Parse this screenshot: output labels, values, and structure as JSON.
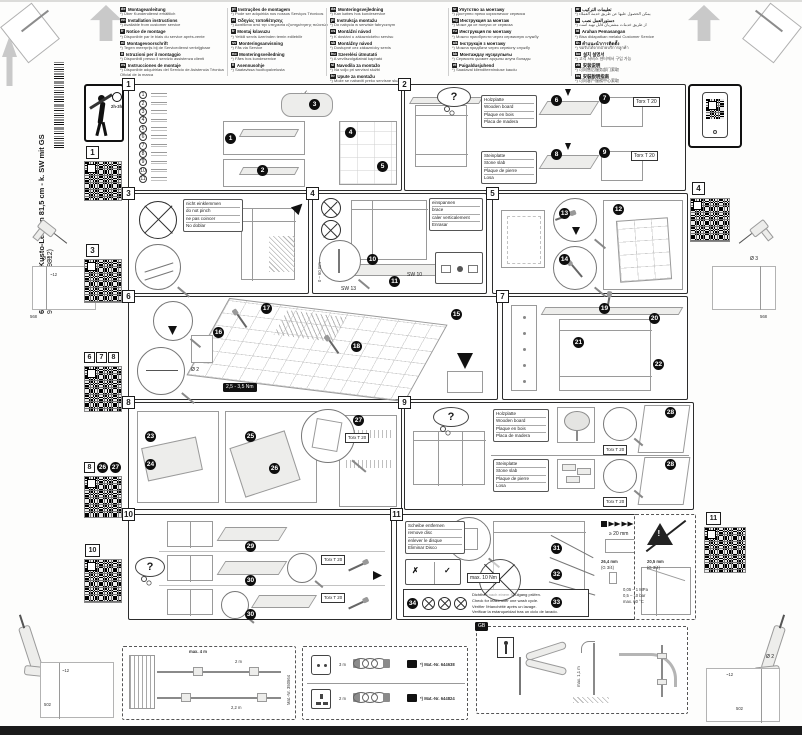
{
  "header": {
    "columns": [
      [
        {
          "code": "de",
          "title": "Montageanleitung",
          "note": "*) Über Kundendienst erhältlich"
        },
        {
          "code": "en",
          "title": "Installation instructions",
          "note": "*) Available from customer service"
        },
        {
          "code": "fr",
          "title": "Notice de montage",
          "note": "*) Disponible par le biais du service après-vente"
        },
        {
          "code": "nl",
          "title": "Montagevoorschrift",
          "note": "*) Tegen meerprijs bij de Servicedienst verkrijgbaar"
        },
        {
          "code": "it",
          "title": "Istruzioni per il montaggio",
          "note": "*) Disponibili presso il servizio assistenza clienti"
        },
        {
          "code": "es",
          "title": "Instrucciones de montaje",
          "note": "*) Disponible adquirirlas del Servicio de Asistencia Técnica Oficial de la marca"
        }
      ],
      [
        {
          "code": "pt",
          "title": "Instruções de montagem",
          "note": "*) Pode ser adquirida nos nossos Serviços Técnicos"
        },
        {
          "code": "el",
          "title": "Οδηγίες τοποθέτησης",
          "note": "*) Διατίθεται από την υπηρεσία εξυπηρέτησης πελατών"
        },
        {
          "code": "tr",
          "title": "Montaj kılavuzu",
          "note": "*) Yetkili servis üzerinden temin edilebilir"
        },
        {
          "code": "sv",
          "title": "Monteringsanvisning",
          "note": "*) Fås via Service"
        },
        {
          "code": "no",
          "title": "Monteringsveiledning",
          "note": "*) Fåes hos kundeservice"
        },
        {
          "code": "fi",
          "title": "Asennusohje",
          "note": "*) Saatavissa huoltopalvelusta"
        }
      ],
      [
        {
          "code": "da",
          "title": "Monteringsvejledning",
          "note": "*) Kan købes hos kundeservice"
        },
        {
          "code": "pl",
          "title": "Instrukcja montażu",
          "note": "*) Do nabycia w serwisie fabrycznym"
        },
        {
          "code": "cs",
          "title": "Montážní návod",
          "note": "*) K dostání u zákaznického servisu"
        },
        {
          "code": "sk",
          "title": "Montážny návod",
          "note": "*) Dostupné cez zákaznícky servis"
        },
        {
          "code": "hu",
          "title": "Szerelési útmutató",
          "note": "*) A vevőszolgálatnál kapható"
        },
        {
          "code": "sl",
          "title": "Navodila za montažo",
          "note": "*) Na voljo pri servisni službi"
        },
        {
          "code": "hr",
          "title": "Upute za montažu",
          "note": "*) Može se nabaviti preko servisne službe"
        },
        {
          "code": "ro",
          "title": "Instrucţiuni de montaj",
          "note": "*) Se pot procura prin unităţile service"
        }
      ],
      [
        {
          "code": "sr",
          "title": "Упутство за монтажу",
          "note": "*) Доступно преко корисничког сервиса"
        },
        {
          "code": "bg",
          "title": "Инструкция за монтаж",
          "note": "*) Може да се получи от сервиза"
        },
        {
          "code": "ru",
          "title": "Инструкция по монтажу",
          "note": "*) Можно приобрести через сервисную службу"
        },
        {
          "code": "uk",
          "title": "Інструкція з монтажу",
          "note": "*) Можна придбати через сервісну службу"
        },
        {
          "code": "kk",
          "title": "Монтаждау нұсқаулығы",
          "note": "*) Сервистік қызмет арқылы алуға болады"
        },
        {
          "code": "et",
          "title": "Paigaldusjuhend",
          "note": "*) Saadaval klienditeeninduse kaudu"
        }
      ],
      [
        {
          "code": "ar",
          "title": "تعليمات التركيب",
          "note": "*) يمكن الحصول عليها عن طريق خدمة العملاء"
        },
        {
          "code": "fa",
          "title": "دستورالعمل نصب",
          "note": "*) از طریق خدمات مشتریان قابل تهیه است"
        },
        {
          "code": "id",
          "title": "Arahan Pemasangan",
          "note": "*) Bisa didapatkan melalui Customer Service"
        },
        {
          "code": "th",
          "title": "คำแนะนำการติดตั้ง",
          "note": "*) ขอรับได้จากฝ่ายบริการลูกค้า"
        },
        {
          "code": "ko",
          "title": "설치 설명서",
          "note": "*) 고객 서비스 센터에서 구입 가능"
        },
        {
          "code": "zh",
          "title": "安装说明",
          "note": "*) 可向售后服务部门索取"
        },
        {
          "code": "tw",
          "title": "安裝說明指南",
          "note": "*) 可向客戶服務中心索取"
        }
      ]
    ]
  },
  "sidebar": {
    "model": "640 B Integr. Kusto-Leisten 81,5 cm - k. SW mit GS",
    "order_no": "9001 170 046 (9812)"
  },
  "margins": {
    "q1": "1",
    "q3": "3",
    "q678": [
      "6",
      "7",
      "8"
    ],
    "q8": "8",
    "q8_badges": [
      "26",
      "27"
    ],
    "q10": "10",
    "q4": "4",
    "q11": "11"
  },
  "labels": {
    "wooden": [
      "Holzplatte",
      "Wooden board",
      "Plaque en bois",
      "Placa de madera"
    ],
    "stone": [
      "Steinplatte",
      "Stone slab",
      "Plaque de pierre",
      "Losa"
    ],
    "pinch": [
      "nicht einklemmen",
      "do not pinch",
      "ne pas coincer",
      "No doblar"
    ],
    "brace": [
      "einspannen",
      "brace",
      "caler verticalement",
      "Enrasar"
    ],
    "disc": [
      "Scheibe entfernen",
      "remove disc",
      "enlever le disque",
      "Eliminar Disco"
    ],
    "leak": [
      "Dichtheit nach einem Spülgang prüfen.",
      "Check for leaks after one wash cycle.",
      "Vérifier l'étanchéité après un lavage.",
      "Verificar la estanqueidad tras un ciclo de lavado."
    ]
  },
  "texts": {
    "time": "2h-3h",
    "torx": "Torx T 20",
    "sw13": "SW 13",
    "sw10": "SW 10",
    "range": "0 – 60 mm",
    "torque": "2,5 - 3,5 Nm",
    "dia3": "Ø 3",
    "dia2": "Ø 2",
    "d568": "568",
    "d12": "~12",
    "d502": "502",
    "maxnm": "max. 10 Nm",
    "gap": "≥ 20 mm",
    "gs": "GS",
    "d1": "26,4 mm",
    "g1": "(G 3/4)",
    "d2": "20,5 mm",
    "g2": "(G 3/4)",
    "mpa": "0,05 – 1 MPa",
    "bar": "0,5 – 10 bar",
    "temp": "max. 60 °C",
    "hosemax": "max. 4 m",
    "l2m": "2 m",
    "l22m": "2,2 m",
    "mat0": "Mat.-Nr. 350564",
    "len1": "3 m",
    "len2": "2 m",
    "mat1": "*) Mat.-Nr. 644638",
    "mat2": "*) Mat.-Nr. 644824",
    "gb": "GB",
    "drain": "max. 1,1 m",
    "q": "?",
    "scissors": "✂",
    "check": "✓",
    "cross": "✗",
    "warn": "!"
  },
  "panels": {
    "p1": {
      "label": "1",
      "parts": [
        "1",
        "2",
        "3",
        "4",
        "5",
        "6",
        "7",
        "8",
        "9",
        "10",
        "11"
      ],
      "badges": [
        "1",
        "2",
        "3",
        "4",
        "5"
      ]
    },
    "p2": {
      "label": "2",
      "badges": [
        "6",
        "7",
        "8",
        "9"
      ]
    },
    "p3": {
      "label": "3"
    },
    "p4": {
      "label": "4",
      "badges": [
        "10",
        "11"
      ]
    },
    "p5": {
      "label": "5",
      "badges": [
        "12",
        "13",
        "14"
      ]
    },
    "p6": {
      "label": "6",
      "badges": [
        "15",
        "16",
        "17",
        "18"
      ]
    },
    "p7": {
      "label": "7",
      "badges": [
        "19",
        "20",
        "21",
        "22"
      ]
    },
    "p8": {
      "label": "8",
      "badges": [
        "23",
        "24",
        "25",
        "26",
        "27"
      ]
    },
    "p9": {
      "label": "9",
      "badges": [
        "28",
        "28"
      ]
    },
    "p10": {
      "label": "10",
      "badges": [
        "29",
        "30",
        "30"
      ]
    },
    "p11": {
      "label": "11",
      "badges": [
        "31",
        "32",
        "33"
      ],
      "badge_note": "34"
    }
  }
}
